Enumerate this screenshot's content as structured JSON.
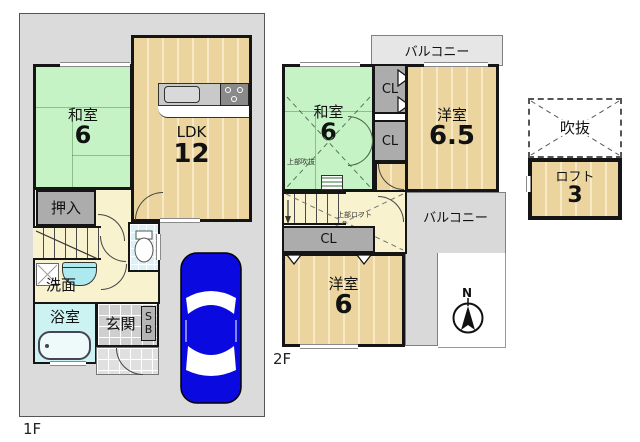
{
  "colors": {
    "tatami_green": "#c6f3c6",
    "wood_floor": "#ecd49e",
    "hall_cream": "#f8f2ce",
    "closet_gray": "#acacac",
    "bath_cyan": "#cdf2f2",
    "site_gray": "#dbdbdb",
    "car_blue": "#0a0ae0",
    "wall_black": "#151515"
  },
  "floor1": {
    "label": "1F",
    "washitsu": {
      "name": "和室",
      "size": "6"
    },
    "ldk": {
      "name": "LDK",
      "size": "12"
    },
    "oshiire": "押入",
    "senmen": "洗面",
    "yokushitsu": "浴室",
    "genkan": "玄関",
    "shoebox_s": "S",
    "shoebox_b": "B"
  },
  "floor2": {
    "label": "2F",
    "balcony_top": "バルコニー",
    "balcony_right": "バルコニー",
    "washitsu": {
      "name": "和室",
      "size": "6"
    },
    "yoshitsu_65": {
      "name": "洋室",
      "size": "6.5"
    },
    "yoshitsu_6": {
      "name": "洋室",
      "size": "6"
    },
    "cl_top": "CL",
    "cl_mid": "CL",
    "cl_bottom": "CL",
    "note_void": "上部吹抜",
    "note_loft": "上部ロフト",
    "compass_north": "N"
  },
  "loft": {
    "void": "吹抜",
    "room": {
      "name": "ロフト",
      "size": "3"
    }
  }
}
